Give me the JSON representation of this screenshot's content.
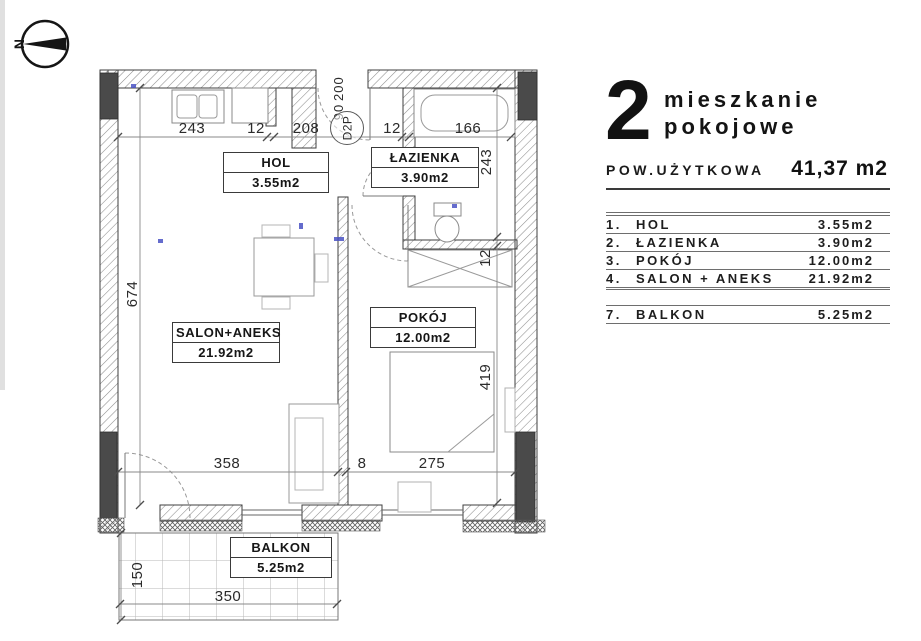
{
  "compass": {
    "north_label": "N"
  },
  "plan": {
    "rooms": {
      "hol": {
        "name": "HOL",
        "area": "3.55m2"
      },
      "lazienka": {
        "name": "ŁAZIENKA",
        "area": "3.90m2"
      },
      "pokoj": {
        "name": "POKÓJ",
        "area": "12.00m2"
      },
      "salon": {
        "name": "SALON+ANEKS",
        "area": "21.92m2"
      },
      "balkon": {
        "name": "BALKON",
        "area": "5.25m2"
      }
    },
    "dims": {
      "top_243": "243",
      "top_12a": "12",
      "top_208": "208",
      "top_12b": "12",
      "top_166": "166",
      "right_243": "243",
      "right_12": "12",
      "right_419": "419",
      "left_674": "674",
      "bottom_358": "358",
      "bottom_8": "8",
      "bottom_275": "275",
      "balcony_150": "150",
      "balcony_350": "350"
    },
    "entrance_door": {
      "width": "90",
      "height": "200",
      "code": "D2P"
    }
  },
  "panel": {
    "number": "2",
    "title_line1": "mieszkanie",
    "title_line2": "pokojowe",
    "area_label": "POW.UŻYTKOWA",
    "area_value": "41,37 m2",
    "legend": {
      "rows": [
        {
          "no": "1.",
          "label": "HOL",
          "value": "3.55m2"
        },
        {
          "no": "2.",
          "label": "ŁAZIENKA",
          "value": "3.90m2"
        },
        {
          "no": "3.",
          "label": "POKÓJ",
          "value": "12.00m2"
        },
        {
          "no": "4.",
          "label": "SALON + ANEKS",
          "value": "21.92m2",
          "double_bottom": true
        },
        {
          "spacer": true
        },
        {
          "no": "7.",
          "label": "BALKON",
          "value": "5.25m2"
        }
      ]
    }
  },
  "colors": {
    "ink": "#1c1c1c",
    "wall_dark": "#4a4a4a",
    "line_gray": "#8a8a8a",
    "artifact_blue": "#4a52c4"
  }
}
